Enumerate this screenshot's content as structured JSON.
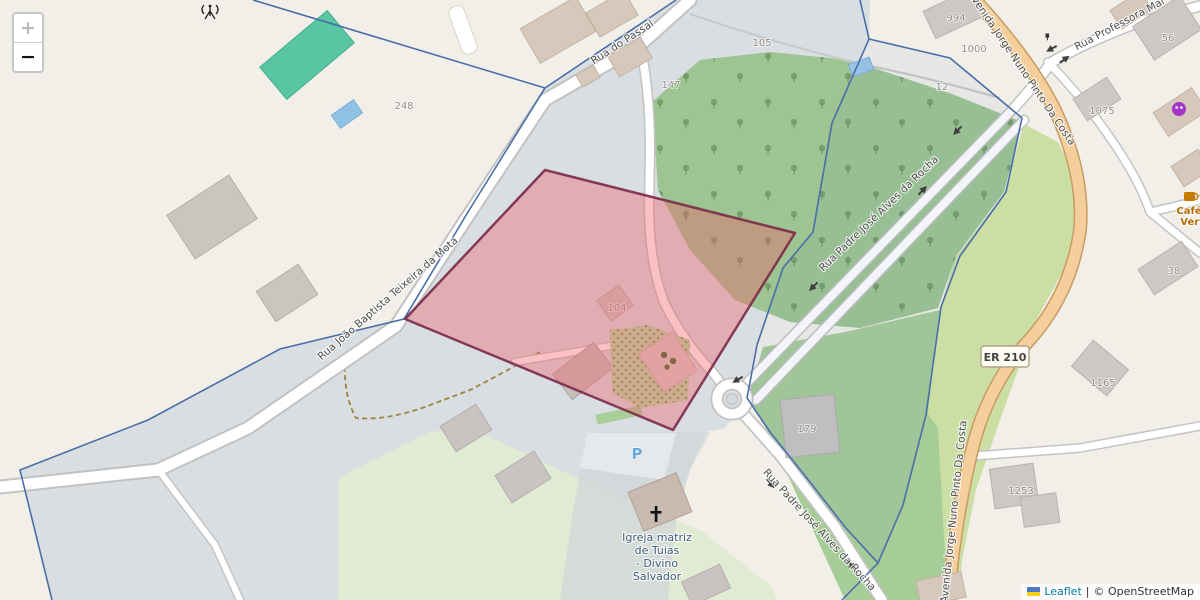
{
  "map": {
    "streets": {
      "passal": "Rua do Passal",
      "joao_baptista": "Rua João Baptista Teixeira da Mota",
      "padre_upper": "Rua Padre José Alves da Rocha",
      "padre_lower": "Rua Padre José Alves da Rocha",
      "professora": "Rua Professora Mai",
      "avenida_top": "Avenida Jorge Nuno Pinto Da Costa",
      "avenida_bottom": "Avenida Jorge Nuno Pinto Da Costa"
    },
    "route_badge": "ER 210",
    "house_numbers": {
      "n248": "248",
      "n147": "147",
      "n105": "105",
      "n104": "104",
      "n994": "994",
      "n1000": "1000",
      "n12": "12",
      "n1075": "1075",
      "n56": "56",
      "n38": "38",
      "n1165": "1165",
      "n179": "179",
      "n1253": "1253"
    },
    "poi": {
      "church": {
        "line1": "Igreja matriz",
        "line2": "de Tuias",
        "line3": "- Divino",
        "line4": "Salvador"
      },
      "cafe": {
        "line1": "Café",
        "line2": "Verv"
      },
      "parking_symbol": "P"
    },
    "colors": {
      "selection_fill": "#f25c66",
      "selection_stroke": "#7a2a4a",
      "boundary_blue": "#4a6fa8",
      "forest_green": "#9ec492",
      "mid_green": "#a6cc97",
      "pale_green": "#cbdfa5",
      "residential_gray": "#d9dee2",
      "cream": "#f2efe9",
      "primary_road": "#f5cf9b",
      "teal_building": "#58c6a3",
      "water_blue": "#90c2e6"
    }
  },
  "controls": {
    "zoom_in": "+",
    "zoom_out": "−"
  },
  "attribution": {
    "leaflet_link": "Leaflet",
    "separator": "|",
    "osm_text": "© OpenStreetMap"
  }
}
